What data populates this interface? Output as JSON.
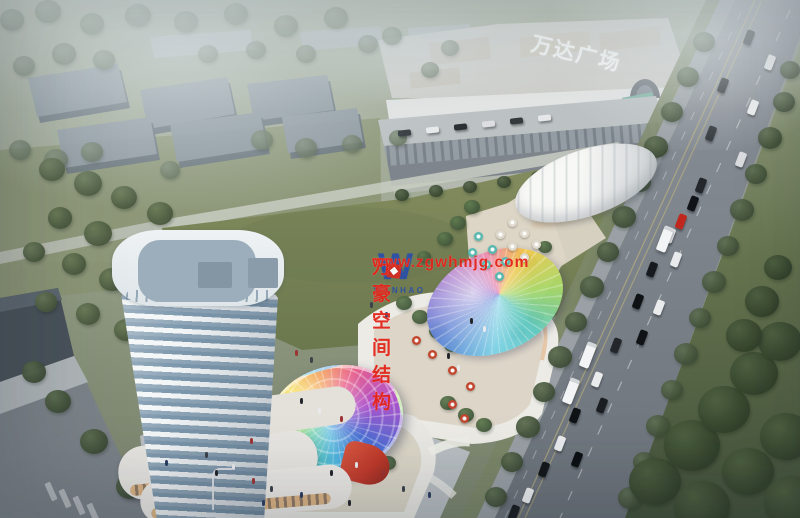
{
  "scene_title": "aerial-rendering-commercial-complex",
  "signage": {
    "mall_roof_sign": "万达广场"
  },
  "watermark": {
    "logo_letter": "W",
    "logo_word": "WANHAO",
    "company": "万豪空间结构",
    "website": "www.zgwhmjg.com"
  },
  "palette": {
    "haze_sky": "#c7cfd3",
    "distant_building": "#8a96a1",
    "field_green": "#7b8659",
    "grass_left": "#7a855f",
    "road_gray": "#757c84",
    "sidewalk": "#9aa0a5",
    "lawn_dark": "#45543a",
    "mall_white": "#e2e4e3",
    "tower_white": "#eef2f4",
    "tower_glass": "#7d98ad",
    "terrace_cream": "#ddd6c6",
    "umbrella_teal": "#57b8b0",
    "accent_red": "#c0392b",
    "watermark_red": "#e42318",
    "logo_blue": "#2b50a8",
    "logo_red": "#d42a22",
    "dome_rainbow": [
      "#4a6fd4",
      "#52b9e0",
      "#58c9a0",
      "#bfe04e",
      "#f5d94e",
      "#f0943c",
      "#e85f8a",
      "#b052c9"
    ]
  }
}
